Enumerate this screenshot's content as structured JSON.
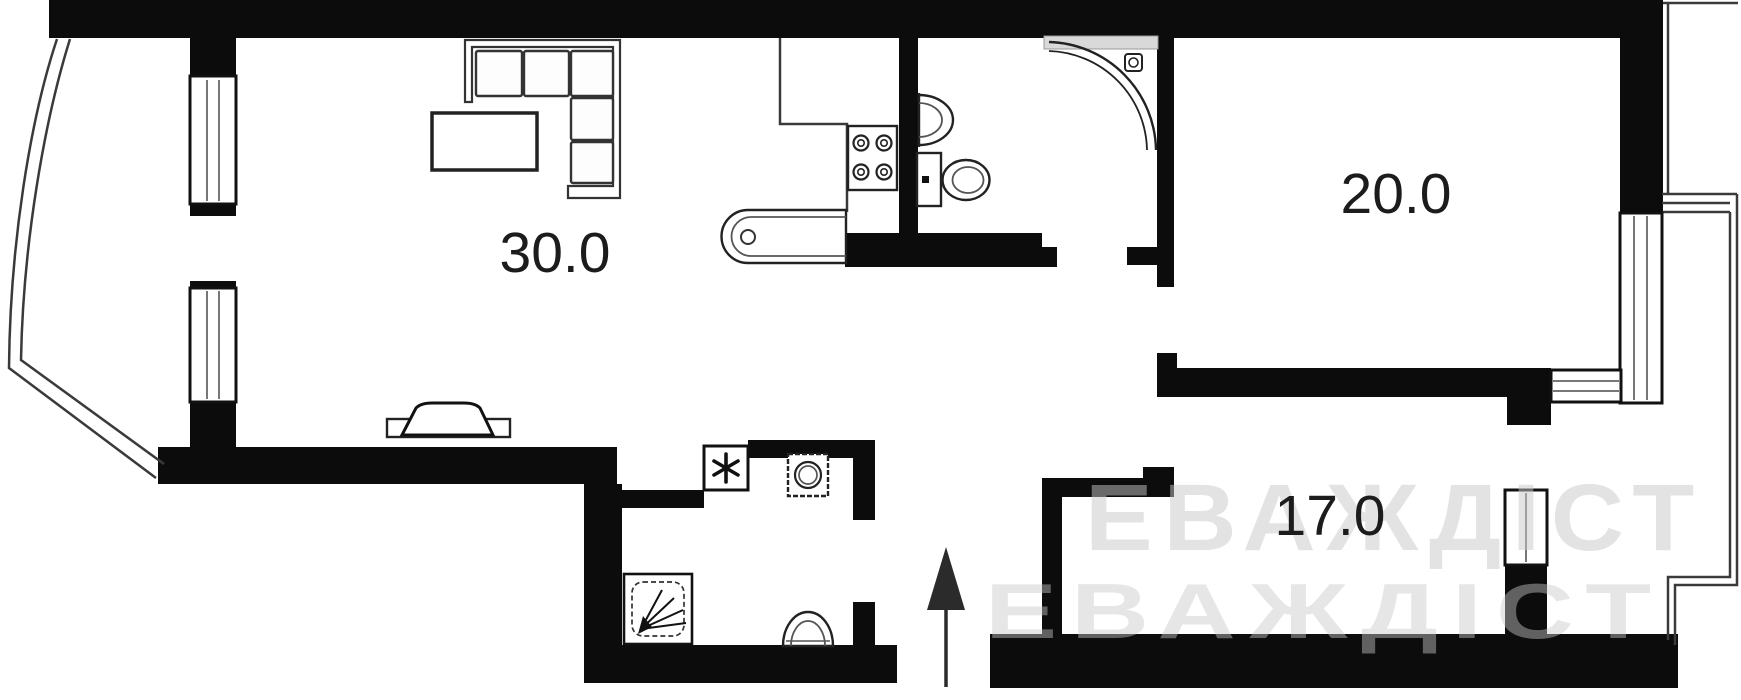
{
  "plan": {
    "type": "apartment-floor-plan",
    "rooms": [
      {
        "id": "living-room-kitchen",
        "area_label": "30.0"
      },
      {
        "id": "bedroom",
        "area_label": "20.0"
      },
      {
        "id": "second-room",
        "area_label": "17.0"
      }
    ],
    "fixtures": [
      "corner-sofa",
      "coffee-table",
      "tv-stand",
      "stove-4-burners",
      "kitchen-island-sink",
      "wash-basin",
      "toilet",
      "corner-shower",
      "vent-shaft",
      "washing-machine",
      "shower-tray",
      "toilet-2",
      "entrance-arrow",
      "windows",
      "balcony-outline"
    ],
    "watermark": {
      "line1": "ЕВАЖДІСТ",
      "line2": "ЕВАЖДІСТ"
    },
    "colors": {
      "wall": "#0c0c0c",
      "background": "#ffffff",
      "outline": "#3a3a3a",
      "watermark": "#c8c8c8"
    }
  }
}
